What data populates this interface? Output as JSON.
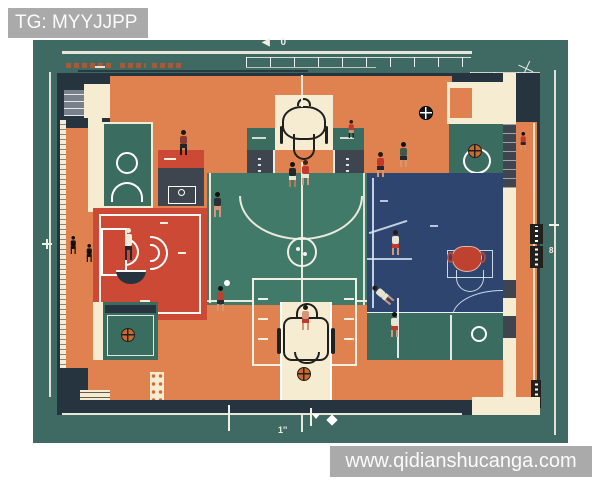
{
  "palette": {
    "page_bg": "#ffffff",
    "canvas_teal": "#3f6a63",
    "frame_navy": "#263440",
    "panel_slate": "#3e454e",
    "base_orange": "#e08150",
    "cream": "#f5ecd1",
    "red_zone": "#cc4a35",
    "red_accent": "#bf4231",
    "blue_zone": "#2e4570",
    "court_teal": "#427a69",
    "panel_teal": "#3a6d60",
    "line_white": "#f2efe3",
    "blue_line": "#dce7f2",
    "ball_orange": "#c96a31",
    "ink": "#20201e",
    "skin": "#d39677",
    "watermark_gray": "#a7a7a7",
    "watermark_text": "#fbfbfb"
  },
  "watermarks": {
    "channel": "TG: MYYJJPP",
    "website": "www.qidianshucanga.com"
  },
  "blueprint": {
    "markers": {
      "top": "◀ 0",
      "right": "8",
      "bottom": "1''"
    }
  },
  "icons": {
    "arrow_left": "◀",
    "hoop_top": "css-shape",
    "hoop_bottom": "css-shape",
    "basketball": "css-shape",
    "person_badge": "css-shape",
    "film_strip": "css-shape",
    "compass": "css-shape",
    "key_plan": "css-shape",
    "diamond_marker": "css-shape"
  }
}
